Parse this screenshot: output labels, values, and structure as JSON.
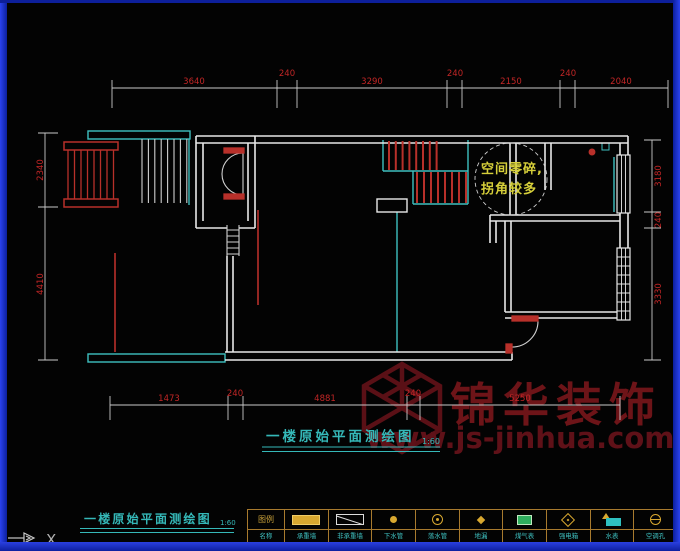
{
  "colors": {
    "wall_white": "#e8e8e8",
    "demolition_red": "#b8302a",
    "dim_red": "#c22626",
    "cad_cyan": "#3fc0c0",
    "annotation_yellow": "#d6cf3a",
    "title_cyan": "#35b8b8",
    "watermark_red": "#5c1014",
    "legend_grid": "#a87a2e",
    "frame_blue": "#1c33dd",
    "background": "#030303"
  },
  "plan_title": {
    "text": "一楼原始平面测绘图",
    "scale": "1:60"
  },
  "footer_title": {
    "text": "一楼原始平面测绘图",
    "scale": "1:60"
  },
  "annotation": {
    "line1": "空间零碎,",
    "line2": "拐角较多"
  },
  "watermark": {
    "brand": "锦华装饰",
    "url": "www.js-jinhua.com",
    "logo": "jinhua-cube-logo"
  },
  "ucs": {
    "axis_label": "X"
  },
  "dims": {
    "top": [
      "3640",
      "240",
      "3290",
      "240",
      "2150",
      "240",
      "2040"
    ],
    "left": [
      "2340",
      "4410"
    ],
    "right": [
      "3180",
      "240",
      "3330"
    ],
    "bottom": [
      "1473",
      "240",
      "4881",
      "240",
      "5250"
    ]
  },
  "legend": {
    "header": {
      "top": "图例",
      "bottom": "名称"
    },
    "items": [
      {
        "icon": "load-bearing-wall-icon",
        "label": "承重墙"
      },
      {
        "icon": "non-load-bearing-wall-icon",
        "label": "非承重墙"
      },
      {
        "icon": "down-pipe-icon",
        "label": "下水管"
      },
      {
        "icon": "rain-pipe-icon",
        "label": "落水管"
      },
      {
        "icon": "floor-drain-icon",
        "label": "地漏"
      },
      {
        "icon": "gas-meter-icon",
        "label": "煤气表"
      },
      {
        "icon": "power-box-icon",
        "label": "强电箱"
      },
      {
        "icon": "water-meter-icon",
        "label": "水表"
      },
      {
        "icon": "ac-hole-icon",
        "label": "空调孔"
      }
    ]
  }
}
